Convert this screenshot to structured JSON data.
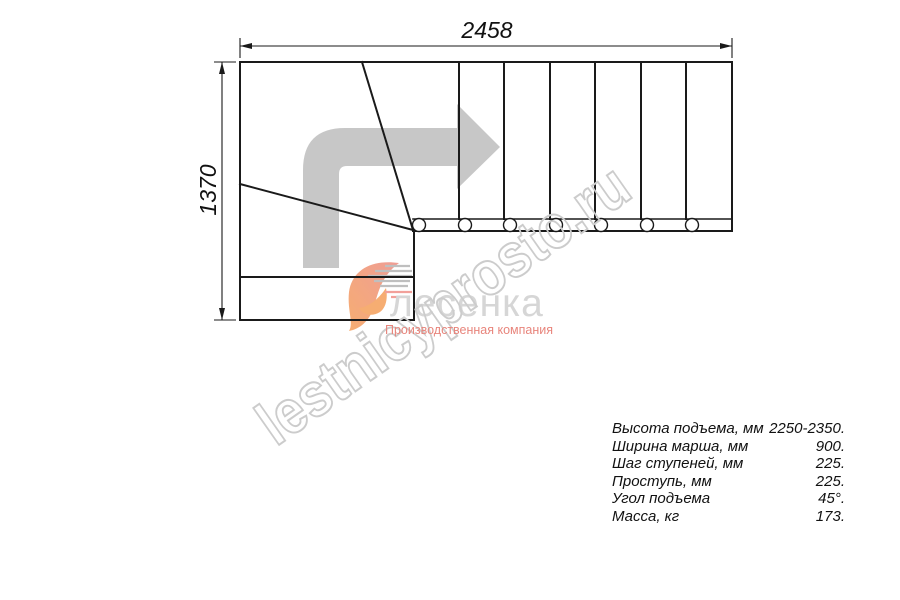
{
  "drawing": {
    "kind": "stair-plan-top-view",
    "dimension_width_label": "2458",
    "dimension_height_label": "1370",
    "line_color": "#1a1a1a",
    "baluster_count": 7
  },
  "direction_arrow": {
    "color": "#c7c7c7"
  },
  "watermark": {
    "text": "lestnicyprosto.ru",
    "color": "#cccccc"
  },
  "logo": {
    "name": "лесенка",
    "name_color": "#d6d6d6",
    "tagline": "Производственная компания",
    "tagline_color": "#e8857c",
    "swoosh_orange": "#f6ad72",
    "swoosh_salmon": "#ef9d95",
    "speedline_gray": "#bfbfbf"
  },
  "specs": {
    "rows": [
      {
        "label": "Высота подъема, мм",
        "value": "2250-2350."
      },
      {
        "label": "Ширина марша, мм",
        "value": "900."
      },
      {
        "label": "Шаг ступеней, мм",
        "value": "225."
      },
      {
        "label": "Проступь, мм",
        "value": "225."
      },
      {
        "label": "Угол подъема",
        "value": "45°."
      },
      {
        "label": "Масса, кг",
        "value": "173."
      }
    ]
  }
}
